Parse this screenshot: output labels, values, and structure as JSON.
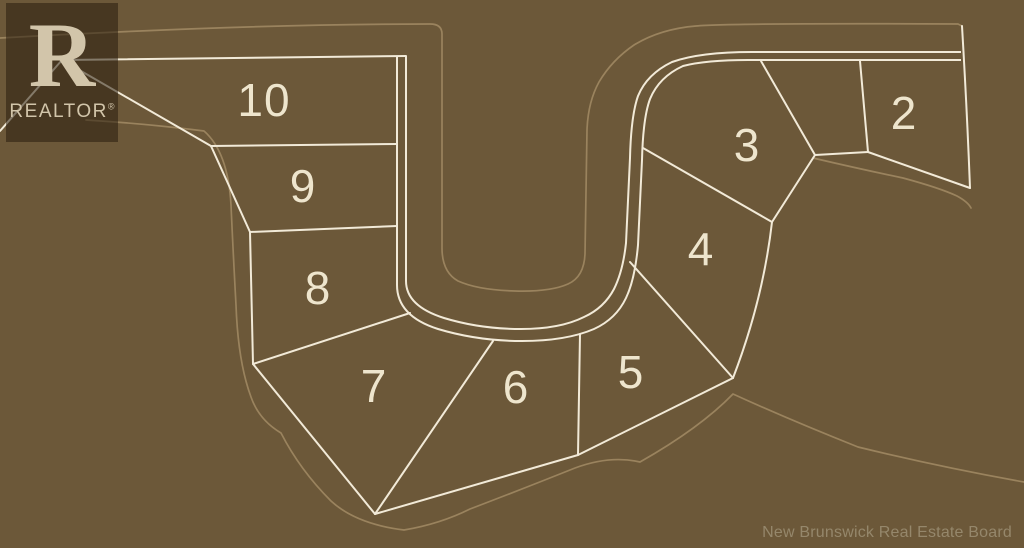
{
  "map": {
    "lots": [
      {
        "number": "2",
        "x": 904,
        "y": 113
      },
      {
        "number": "3",
        "x": 747,
        "y": 145
      },
      {
        "number": "4",
        "x": 701,
        "y": 249
      },
      {
        "number": "5",
        "x": 631,
        "y": 372
      },
      {
        "number": "6",
        "x": 516,
        "y": 387
      },
      {
        "number": "7",
        "x": 374,
        "y": 386
      },
      {
        "number": "8",
        "x": 318,
        "y": 288
      },
      {
        "number": "9",
        "x": 303,
        "y": 186
      },
      {
        "number": "10",
        "x": 264,
        "y": 100
      }
    ],
    "logo": {
      "glyph": "R",
      "brand": "REALTOR",
      "registered": "®"
    },
    "attribution": "New Brunswick Real Estate Board",
    "colors": {
      "background": "#6c5839",
      "lot_line": "#f2ead8",
      "faint_boundary": "#9d8660",
      "label": "#eee5cd",
      "attribution_text": "#95876b",
      "logo_overlay": "rgba(42,30,15,0.55)",
      "logo_text": "#d2c5aa"
    }
  }
}
